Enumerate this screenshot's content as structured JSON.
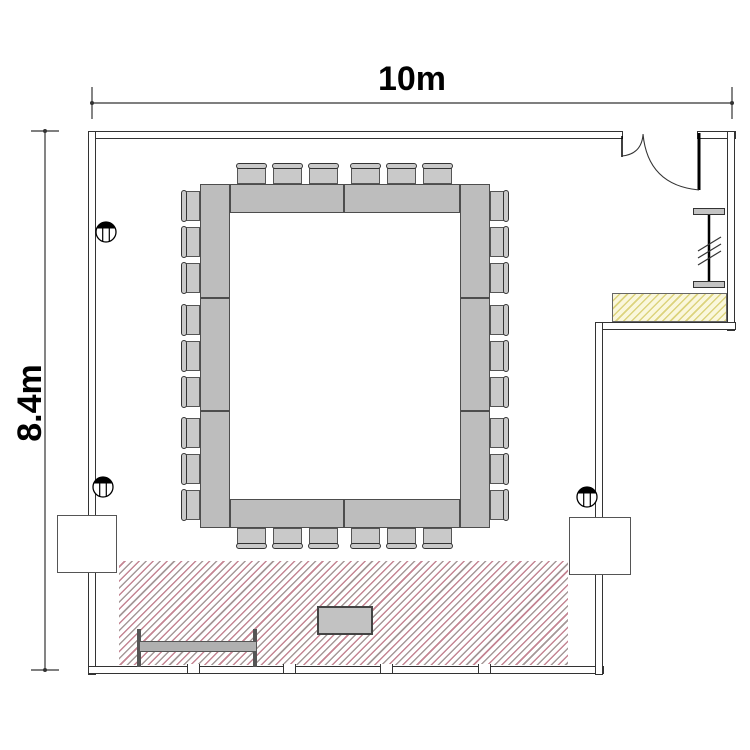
{
  "title": "Meeting room floor plan",
  "dimensions": {
    "width_label": "10m",
    "height_label": "8.4m"
  },
  "room": {
    "door": "unequal double swing door at top right",
    "alcove": "entry alcove on right side with counter and movable partition",
    "window_wall": "bottom wall with 4 mullion breaks"
  },
  "furniture": {
    "conference_table": {
      "type": "hollow-rectangle",
      "segments": 10
    },
    "chairs": {
      "total": 30,
      "left": 9,
      "right": 9,
      "top": 6,
      "bottom": 6
    },
    "stage_area": {
      "style": "diagonal hatch",
      "position": "bottom"
    },
    "counter": {
      "style": "yellow hatch",
      "position": "right alcove"
    },
    "podium_table": 1,
    "bench": 1,
    "wall_pilasters": 2,
    "floor_markers": 3
  },
  "symbols": {
    "floor_marker": "circle, filled top segment, vertical hatch",
    "partition": "I-bar with three slash ticks",
    "door_swing": "two quarter-circle arcs"
  },
  "colors": {
    "wall_line": "#333333",
    "table_fill": "#bdbdbd",
    "table_border": "#4d4d4d",
    "chair_fill": "#c9c9c9",
    "chair_border": "#555555",
    "chair_back_border": "#333333",
    "stage_hatch_pink": "#c48593",
    "stage_hatch_gray": "#a59898",
    "counter_fill": "#faf7dc",
    "counter_hatch": "#dcd37c",
    "counter_border": "#666666",
    "podium_fill": "#c2c2c2",
    "podium_border": "#444444",
    "bench_fill": "#b0b0b0",
    "bench_post": "#555555",
    "bench_border": "#555555",
    "partition_cap": "#c4c4c4",
    "pilaster_border": "#555555",
    "dimension_line": "#333333"
  }
}
